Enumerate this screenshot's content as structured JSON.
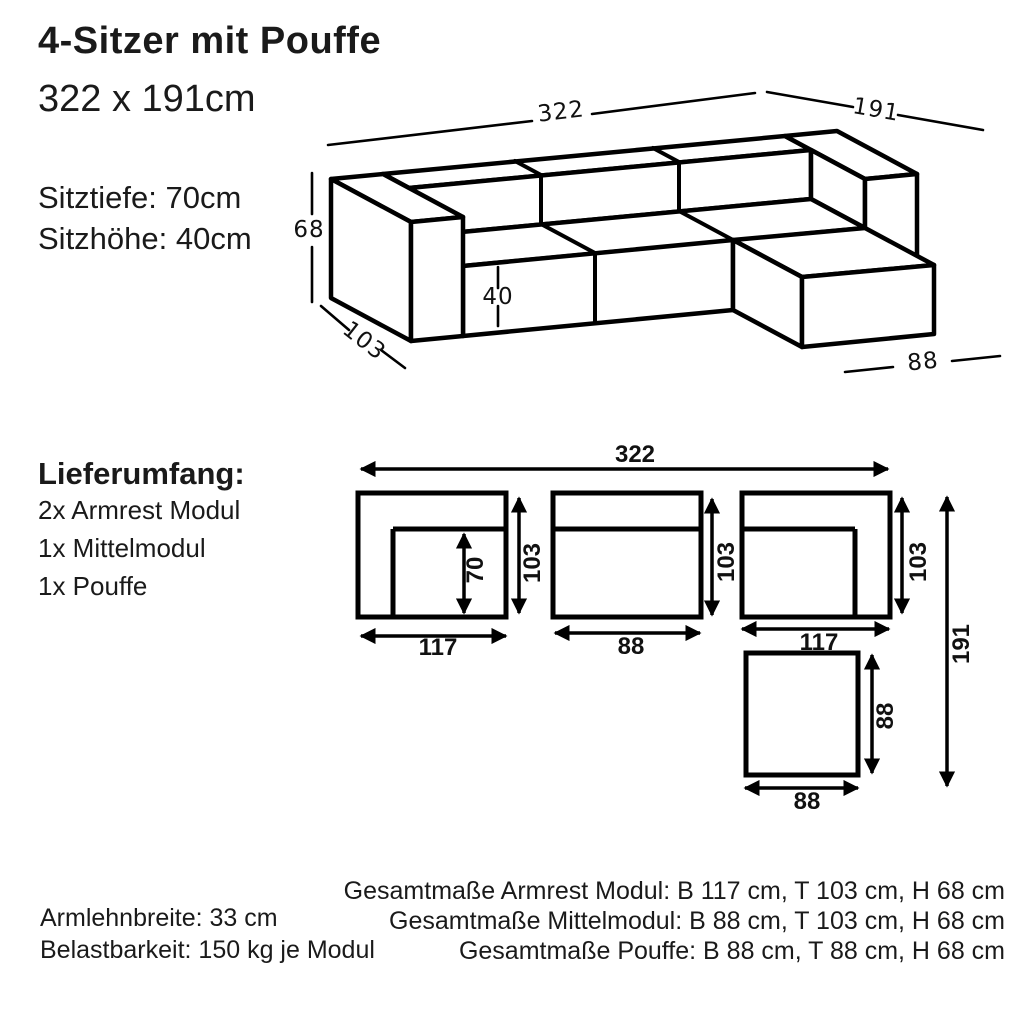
{
  "header": {
    "title": "4-Sitzer mit Pouffe",
    "subtitle": "322 x 191cm",
    "seat_depth": "Sitztiefe: 70cm",
    "seat_height": "Sitzhöhe: 40cm"
  },
  "delivery": {
    "heading": "Lieferumfang:",
    "items": [
      "2x Armrest Modul",
      "1x Mittelmodul",
      "1x Pouffe"
    ]
  },
  "iso_dims": {
    "total_width": "322",
    "total_depth": "191",
    "height": "68",
    "module_depth": "103",
    "seat_height": "40",
    "pouffe_width": "88"
  },
  "plan_dims": {
    "total_width": "322",
    "armrest_left_width": "117",
    "middle_width": "88",
    "armrest_right_width": "117",
    "seat_depth": "70",
    "depth_left": "103",
    "depth_middle": "103",
    "depth_right": "103",
    "total_depth": "191",
    "pouffe_depth": "88",
    "pouffe_width": "88"
  },
  "footer": {
    "left": [
      "Armlehnbreite: 33 cm",
      "Belastbarkeit: 150 kg je Modul"
    ],
    "right": [
      "Gesamtmaße Armrest Modul: B 117 cm, T 103 cm, H 68 cm",
      "Gesamtmaße Mittelmodul: B 88 cm, T 103 cm, H 68 cm",
      "Gesamtmaße Pouffe: B 88 cm, T 88 cm, H 68 cm"
    ]
  },
  "colors": {
    "line": "#000000",
    "text": "#1a1a1a",
    "background": "#ffffff"
  }
}
